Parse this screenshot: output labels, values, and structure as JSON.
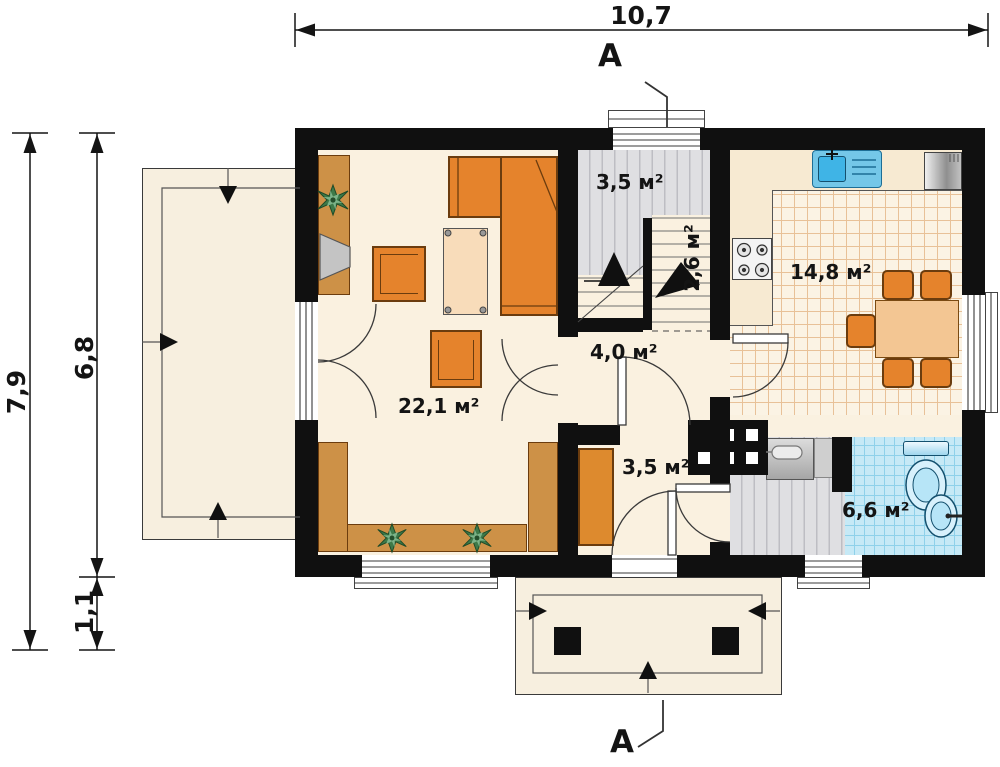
{
  "dimensions": {
    "top_width": "10,7",
    "left_total": "7,9",
    "left_house": "6,8",
    "left_porch": "1,1"
  },
  "sections": {
    "top": "A",
    "bottom": "A"
  },
  "rooms": {
    "living": {
      "label": "22,1 м²"
    },
    "stairs": {
      "label": "3,5 м²"
    },
    "stairs_lower": {
      "label": "2,6 м²"
    },
    "kitchen": {
      "label": "14,8 м²"
    },
    "hall": {
      "label": "4,0 м²"
    },
    "vestibule": {
      "label": "3,5 м²"
    },
    "bathroom": {
      "label": "6,6 м²"
    }
  },
  "colors": {
    "wall": "#101010",
    "floor_cream": "#faf1e0",
    "terrace": "#f7efdf",
    "stair_gray": "#dfdfe2",
    "tile_blue": "#c6e9f6",
    "kitchen_tile_line": "#e8c198",
    "furniture_orange": "#e5832c",
    "wood": "#cd9147",
    "table_light": "#f3c693",
    "fixture_blue": "#d8f1fc"
  }
}
